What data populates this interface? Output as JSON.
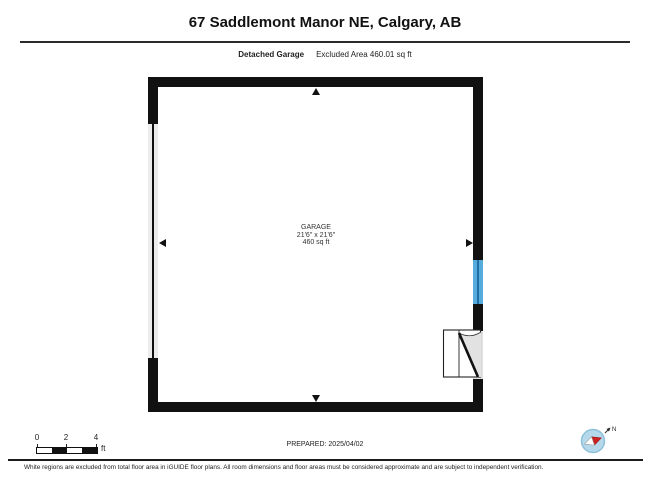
{
  "header": {
    "title": "67 Saddlemont Manor NE, Calgary, AB",
    "floor_label": "Detached Garage",
    "area_label": "Excluded Area 460.01 sq ft"
  },
  "plan": {
    "room": {
      "name": "GARAGE",
      "dimensions": "21'6\" x 21'6\"",
      "area": "460 sq ft"
    },
    "features": [
      "garage-door-left-wall",
      "window-right-wall",
      "door-right-wall-bottom"
    ]
  },
  "scale_bar": {
    "ticks": [
      "0",
      "2",
      "4"
    ],
    "unit": "ft"
  },
  "prepared": {
    "label": "PREPARED: 2025/04/02"
  },
  "compass": {
    "north_label": "N"
  },
  "footer": {
    "disclaimer": "White regions are excluded from total floor area in iGUIDE floor plans. All room dimensions and floor areas must be considered approximate and are subject to independent verification."
  },
  "colors": {
    "wall": "#111111",
    "window_blue": "#55abdc",
    "window_frame_blue": "#1f6fa6",
    "garage_door_gray": "#ececec",
    "compass_fill": "#b5d8eb",
    "compass_needle_red": "#cc2222"
  }
}
